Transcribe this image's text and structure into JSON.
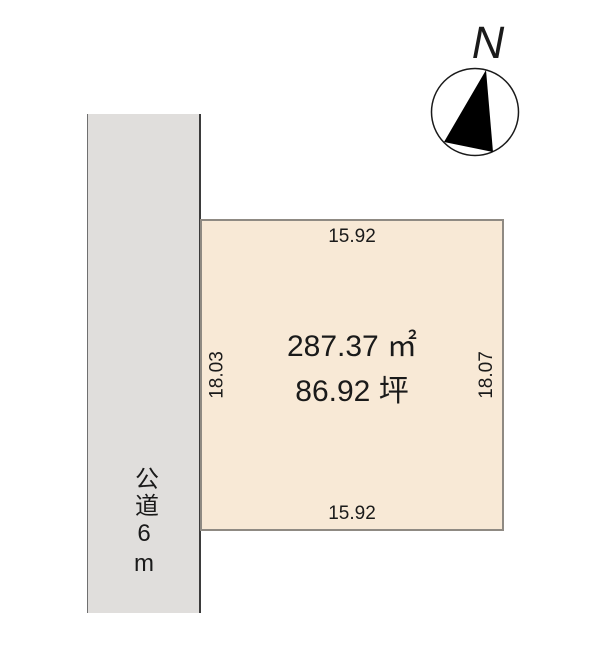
{
  "compass": {
    "north_label": "N"
  },
  "road": {
    "label": "公道6m"
  },
  "parcel": {
    "area_m2": "287.37 ㎡",
    "area_tsubo": "86.92 坪",
    "dim_top": "15.92",
    "dim_bottom": "15.92",
    "dim_left": "18.03",
    "dim_right": "18.07"
  },
  "colors": {
    "parcel-fill": "#f8e9d6",
    "parcel-border": "#8f8a83",
    "road-fill": "#e0dedc",
    "road-border-dark": "#3b3b3b",
    "road-border-light": "#707070",
    "ink": "#1a1a1a"
  }
}
